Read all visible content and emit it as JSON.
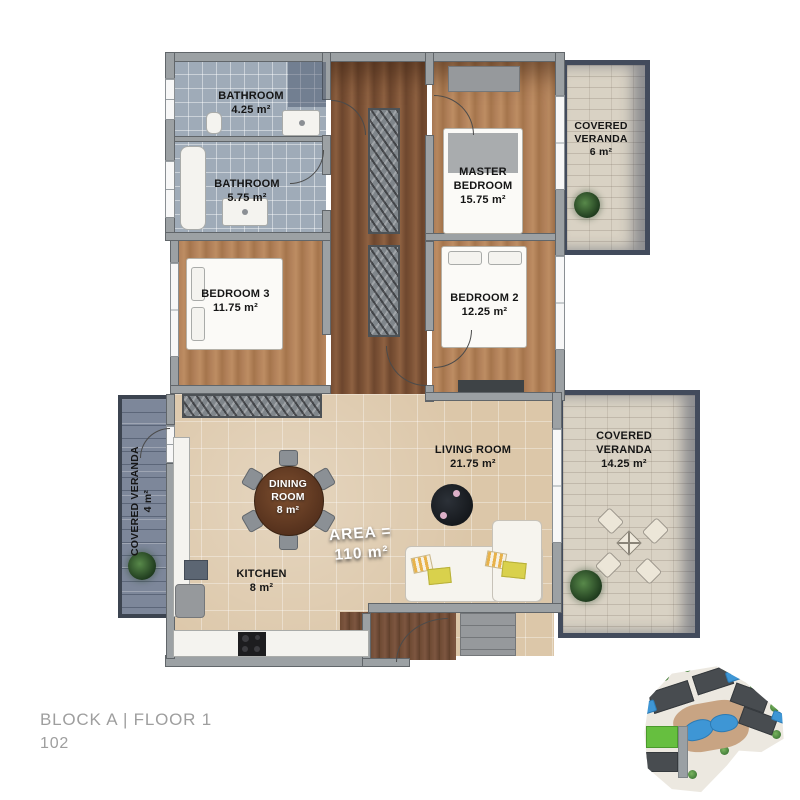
{
  "caption": {
    "block": "BLOCK A | FLOOR 1",
    "unit": "102"
  },
  "area_total": {
    "label": "AREA =",
    "value": "110 m²"
  },
  "rooms": {
    "bathroom_top": {
      "name": "BATHROOM",
      "area": "4.25 m²"
    },
    "bathroom_mid": {
      "name": "BATHROOM",
      "area": "5.75 m²"
    },
    "master_bedroom": {
      "name": "MASTER BEDROOM",
      "area": "15.75 m²"
    },
    "veranda_top": {
      "name": "COVERED VERANDA",
      "area": "6 m²"
    },
    "bedroom3": {
      "name": "BEDROOM 3",
      "area": "11.75 m²"
    },
    "bedroom2": {
      "name": "BEDROOM 2",
      "area": "12.25 m²"
    },
    "living_room": {
      "name": "LIVING ROOM",
      "area": "21.75 m²"
    },
    "dining_room": {
      "name": "DINING ROOM",
      "area": "8 m²"
    },
    "kitchen": {
      "name": "KITCHEN",
      "area": "8 m²"
    },
    "veranda_left": {
      "name": "COVERED VERANDA",
      "area": "4 m²"
    },
    "veranda_right": {
      "name": "COVERED VERANDA",
      "area": "14.25 m²"
    }
  },
  "colors": {
    "wall_gray": "#9ca1a4",
    "wood_floor": "#b2815a",
    "stone_tile": "#dcc7a9",
    "veranda_frame": "#424b5c",
    "highlight_block_green": "#66bf3f",
    "pool_blue": "#3e96d5",
    "caption_gray": "#9e9e9e"
  }
}
